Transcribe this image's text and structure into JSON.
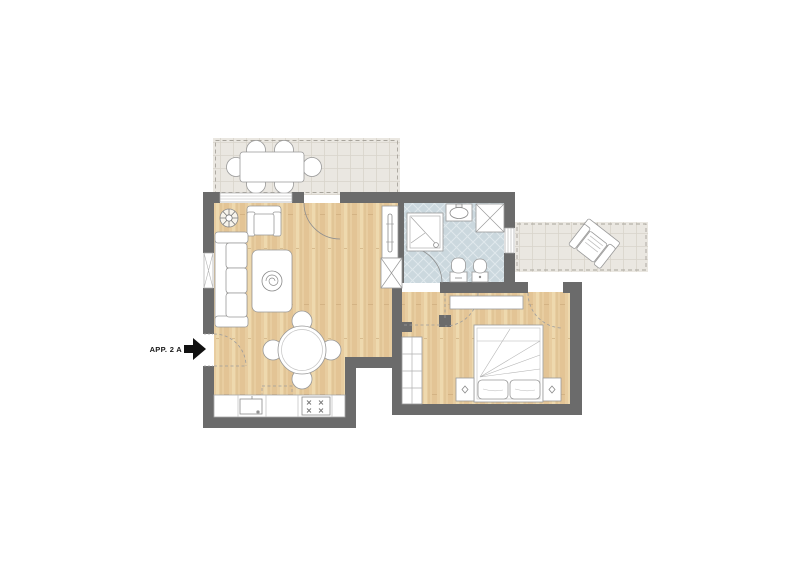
{
  "plan": {
    "entry_label": "APP. 2 A",
    "entry_arrow_icon": "entry-arrow-icon",
    "colors": {
      "wall": "#6b6b6b",
      "wood_floor": "#e8cda0",
      "wood_stripe_dark": "#ddbd8c",
      "wood_stripe_light": "#f0dcb2",
      "terrace_tile": "#eae7e1",
      "terrace_grid": "#d8d4cb",
      "terrace_dash": "#a8a49c",
      "bath_tile": "#cbd8de",
      "bath_grid": "#dfe8ec",
      "furniture_fill": "#ffffff",
      "furniture_outline": "#999999",
      "door_swing": "#9d9d9d",
      "arrow": "#111111"
    },
    "rooms": [
      "living-room",
      "kitchen",
      "bathroom",
      "bedroom",
      "terrace-top",
      "terrace-right"
    ],
    "furniture": [
      "outdoor-dining-table",
      "outdoor-chairs",
      "sofa",
      "armchair",
      "coffee-table",
      "potted-plant",
      "round-dining-table",
      "dining-chairs",
      "kitchen-counter",
      "kitchen-sink",
      "stove",
      "tall-cabinet",
      "utility-cabinet",
      "shower",
      "washbasin",
      "washing-machine",
      "toilet",
      "bidet",
      "dresser",
      "wardrobe",
      "double-bed",
      "pillows",
      "nightstand-left",
      "nightstand-right",
      "terrace-armchair"
    ]
  }
}
